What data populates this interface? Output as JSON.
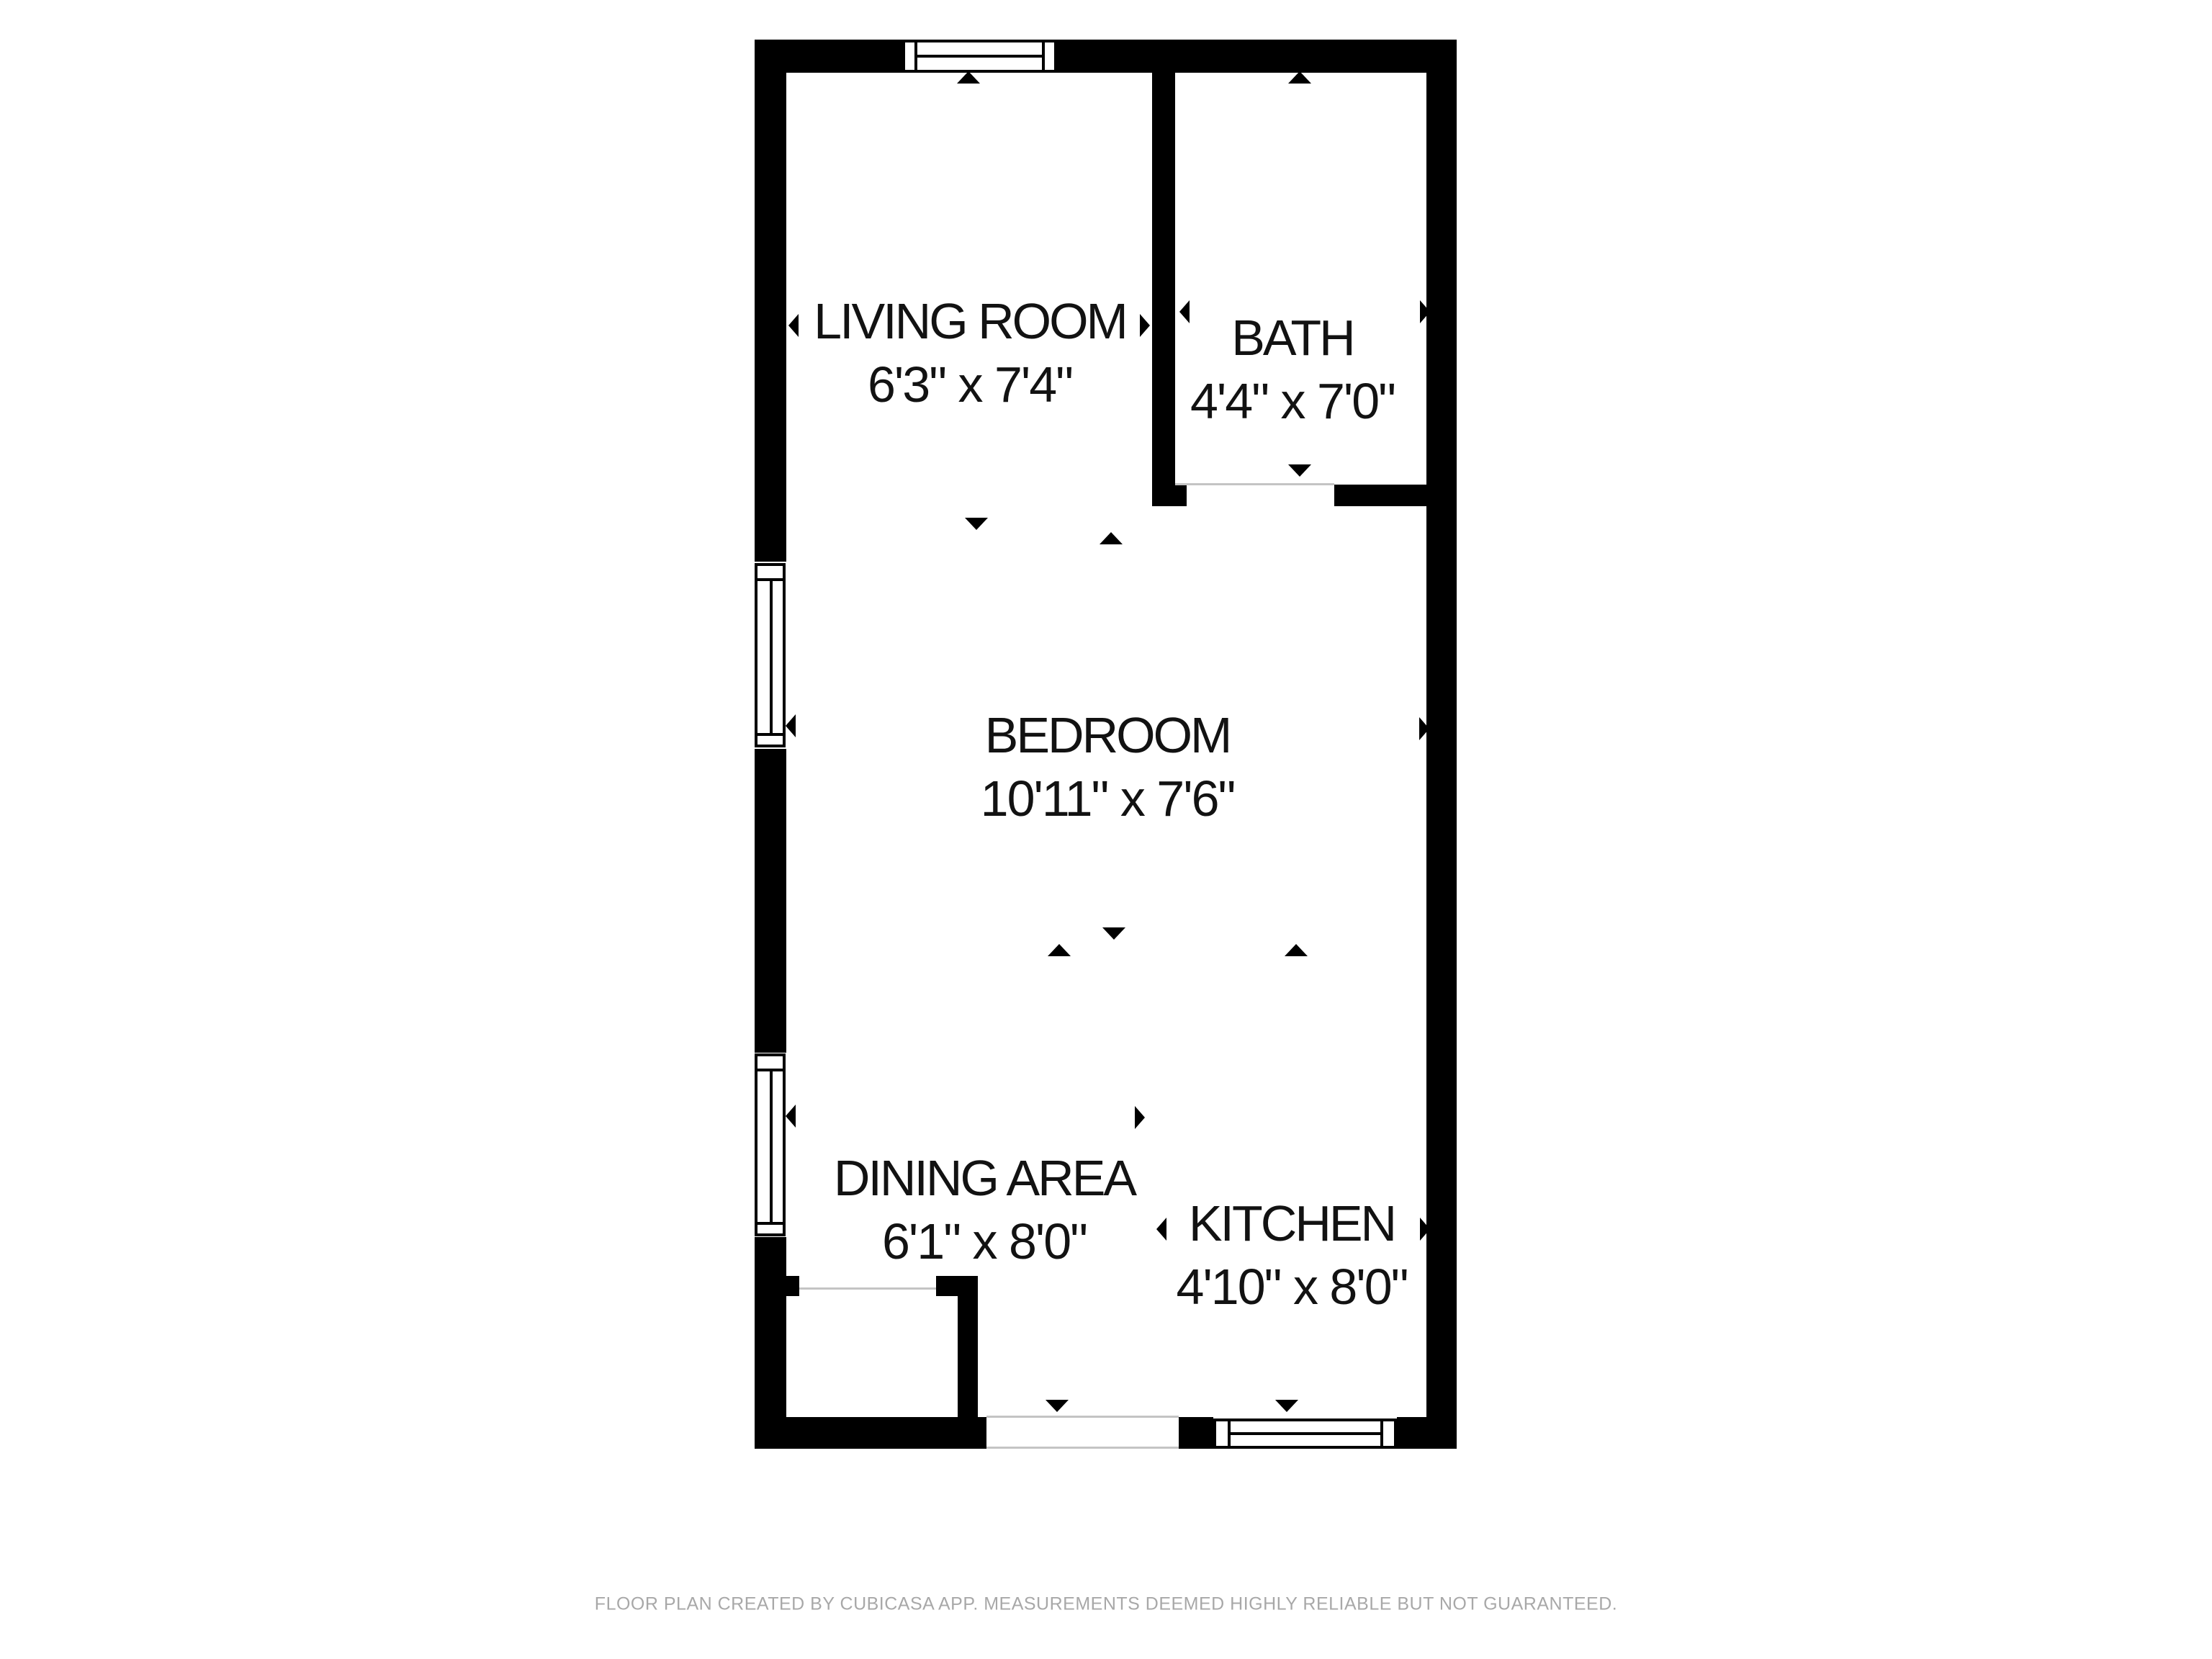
{
  "floor_plan": {
    "rooms": [
      {
        "name": "LIVING ROOM",
        "dimensions": "6'3\" x 7'4\""
      },
      {
        "name": "BATH",
        "dimensions": "4'4\" x 7'0\""
      },
      {
        "name": "BEDROOM",
        "dimensions": "10'11\" x 7'6\""
      },
      {
        "name": "DINING AREA",
        "dimensions": "6'1\" x 8'0\""
      },
      {
        "name": "KITCHEN",
        "dimensions": "4'10\" x 8'0\""
      }
    ],
    "colors": {
      "wall": "#000000",
      "background": "#ffffff",
      "opening_line": "#c4c4c4",
      "label_text": "#121212",
      "footer_text": "#a8a8a8"
    }
  },
  "footer": {
    "disclaimer": "FLOOR PLAN CREATED BY CUBICASA APP. MEASUREMENTS DEEMED HIGHLY RELIABLE BUT NOT GUARANTEED."
  }
}
